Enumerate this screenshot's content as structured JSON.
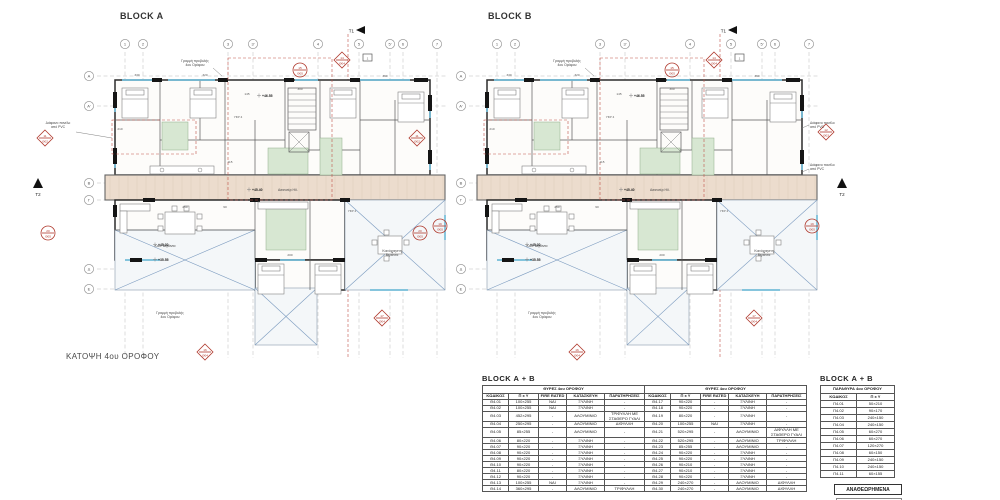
{
  "sheet_title": "ΚΑΤΟΨΗ 4ου ΟΡΟΦΟΥ",
  "blocks": [
    {
      "label": "BLOCK A"
    },
    {
      "label": "BLOCK B"
    }
  ],
  "plan": {
    "grid_columns": [
      "1",
      "2",
      "3",
      "3'",
      "4",
      "5",
      "5'",
      "6",
      "7"
    ],
    "grid_rows": [
      "Α",
      "Α'",
      "Β",
      "Γ",
      "Δ",
      "Ε"
    ],
    "section_marker_top": "T1",
    "section_marker_side": "T2",
    "annotations": {
      "projection_line": "Γραμμή προβολής\n4ου Ορόφου",
      "pvc_panel": "Διάφανο πανέλο\nαπό PVC",
      "veranda_small": "Κοιν. Βεράντα",
      "veranda_common": "Κοινόχρηστη\nΒεράντα",
      "elevator": "Ασανσέρ ΗΛ.",
      "wall_tag": "ΥΣΡ 4",
      "ref_box": "1"
    },
    "elevations": [
      "+46.55",
      "+45.40",
      "+45.30",
      "+35.55"
    ],
    "dimensions": [
      "330",
      "320",
      "300",
      "360",
      "210",
      "145",
      "115",
      "200",
      "250",
      "90"
    ],
    "markers": [
      {
        "shape": "circle",
        "line1": "15",
        "line2": "Θ05"
      },
      {
        "shape": "diamond",
        "line1": "14",
        "line2": "Θ04"
      },
      {
        "shape": "diamond",
        "line1": "11",
        "line2": "Θ02"
      },
      {
        "shape": "circle",
        "line1": "20",
        "line2": "Θ05"
      },
      {
        "shape": "circle",
        "line1": "19",
        "line2": "Θ05"
      },
      {
        "shape": "diamond",
        "line1": "16",
        "line2": "Θ04"
      },
      {
        "shape": "diamond",
        "line1": "17",
        "line2": "Θ04"
      }
    ],
    "marker_b_right": {
      "shape": "diamond",
      "line1": "12",
      "line2": "Θ03"
    }
  },
  "door_table": {
    "block_title": "BLOCK  A + B",
    "section_title": "ΘΥΡΕΣ 4ου ΟΡΟΦΟΥ",
    "headers": [
      "ΚΩΔΙΚΟΣ",
      "Π x Y",
      "FIRE RATED",
      "ΚΑΤΑΣΚΕΥΗ",
      "ΠΑΡΑΤΗΡΗΣΕΙΣ"
    ],
    "rows_left": [
      [
        "Θ4.01",
        "100×255",
        "ΝΑΙ",
        "ΞΥΛΙΝΗ",
        "-"
      ],
      [
        "Θ4.02",
        "100×255",
        "ΝΑΙ",
        "ΞΥΛΙΝΗ",
        "-"
      ],
      [
        "Θ4.03",
        "452×295",
        "-",
        "ΑΛΟΥΜΙΝΙΟ",
        "ΤΡΙΦΥΛΛΗ ΜΕ ΣΤΑΘΕΡΟ ΓΥΑΛΙ"
      ],
      [
        "Θ4.04",
        "250×295",
        "-",
        "ΑΛΟΥΜΙΝΙΟ",
        "ΔΙΦΥΛΛΗ"
      ],
      [
        "Θ4.05",
        "85×255",
        "-",
        "ΑΛΟΥΜΙΝΙΟ",
        "-"
      ],
      [
        "Θ4.06",
        "80×220",
        "-",
        "ΞΥΛΙΝΗ",
        "-"
      ],
      [
        "Θ4.07",
        "90×220",
        "-",
        "ΞΥΛΙΝΗ",
        "-"
      ],
      [
        "Θ4.08",
        "90×220",
        "-",
        "ΞΥΛΙΝΗ",
        "-"
      ],
      [
        "Θ4.09",
        "90×220",
        "-",
        "ΞΥΛΙΝΗ",
        "-"
      ],
      [
        "Θ4.10",
        "90×220",
        "-",
        "ΞΥΛΙΝΗ",
        "-"
      ],
      [
        "Θ4.11",
        "80×220",
        "-",
        "ΞΥΛΙΝΗ",
        "-"
      ],
      [
        "Θ4.12",
        "90×220",
        "-",
        "ΞΥΛΙΝΗ",
        "-"
      ],
      [
        "Θ4.13",
        "100×255",
        "ΝΑΙ",
        "ΞΥΛΙΝΗ",
        "-"
      ],
      [
        "Θ4.14",
        "360×295",
        "-",
        "ΑΛΟΥΜΙΝΙΟ",
        "ΤΡΙΦΥΛΛΗ"
      ]
    ],
    "rows_right": [
      [
        "Θ4.17",
        "90×220",
        "-",
        "ΞΥΛΙΝΗ",
        "-"
      ],
      [
        "Θ4.18",
        "90×220",
        "-",
        "ΞΥΛΙΝΗ",
        "-"
      ],
      [
        "Θ4.19",
        "80×220",
        "-",
        "ΞΥΛΙΝΗ",
        "-"
      ],
      [
        "Θ4.20",
        "100×255",
        "ΝΑΙ",
        "ΞΥΛΙΝΗ",
        "-"
      ],
      [
        "Θ4.21",
        "520×295",
        "-",
        "ΑΛΟΥΜΙΝΙΟ",
        "ΔΙΦΥΛΛΗ ΜΕ ΣΤΑΘΕΡΟ ΓΥΑΛΙ"
      ],
      [
        "Θ4.22",
        "520×295",
        "-",
        "ΑΛΟΥΜΙΝΙΟ",
        "ΤΡΙΦΥΛΛΗ"
      ],
      [
        "Θ4.23",
        "85×255",
        "-",
        "ΑΛΟΥΜΙΝΙΟ",
        "-"
      ],
      [
        "Θ4.24",
        "90×220",
        "-",
        "ΞΥΛΙΝΗ",
        "-"
      ],
      [
        "Θ4.25",
        "90×220",
        "-",
        "ΞΥΛΙΝΗ",
        "-"
      ],
      [
        "Θ4.26",
        "90×210",
        "-",
        "ΞΥΛΙΝΗ",
        "-"
      ],
      [
        "Θ4.27",
        "90×210",
        "-",
        "ΞΥΛΙΝΗ",
        "-"
      ],
      [
        "Θ4.28",
        "90×220",
        "-",
        "ΞΥΛΙΝΗ",
        "-"
      ],
      [
        "Θ4.29",
        "240×270",
        "-",
        "ΑΛΟΥΜΙΝΙΟ",
        "ΔΙΦΥΛΛΗ"
      ],
      [
        "Θ4.30",
        "240×270",
        "-",
        "ΑΛΟΥΜΙΝΙΟ",
        "ΔΙΦΥΛΛΗ"
      ]
    ]
  },
  "window_table": {
    "block_title": "BLOCK  A + B",
    "section_title": "ΠΑΡΑΘΥΡΑ 4ου ΟΡΟΦΟΥ",
    "headers": [
      "ΚΩΔΙΚΟΣ",
      "Π x Y"
    ],
    "rows": [
      [
        "Π4.01",
        "50×210"
      ],
      [
        "Π4.02",
        "90×170"
      ],
      [
        "Π4.03",
        "240×150"
      ],
      [
        "Π4.04",
        "240×150"
      ],
      [
        "Π4.05",
        "60×270"
      ],
      [
        "Π4.06",
        "60×270"
      ],
      [
        "Π4.07",
        "120×270"
      ],
      [
        "Π4.08",
        "60×150"
      ],
      [
        "Π4.09",
        "240×150"
      ],
      [
        "Π4.10",
        "240×150"
      ],
      [
        "Π4.11",
        "60×155"
      ]
    ]
  },
  "revision_box_label": "ΑΝΑΘΕΩΡΗΜΕΝΑ",
  "stamp_name": "ΔΗΜΗΤΡΙΟΣ ΚΩΝΣΤΑΝΤΙΝΟΥ"
}
